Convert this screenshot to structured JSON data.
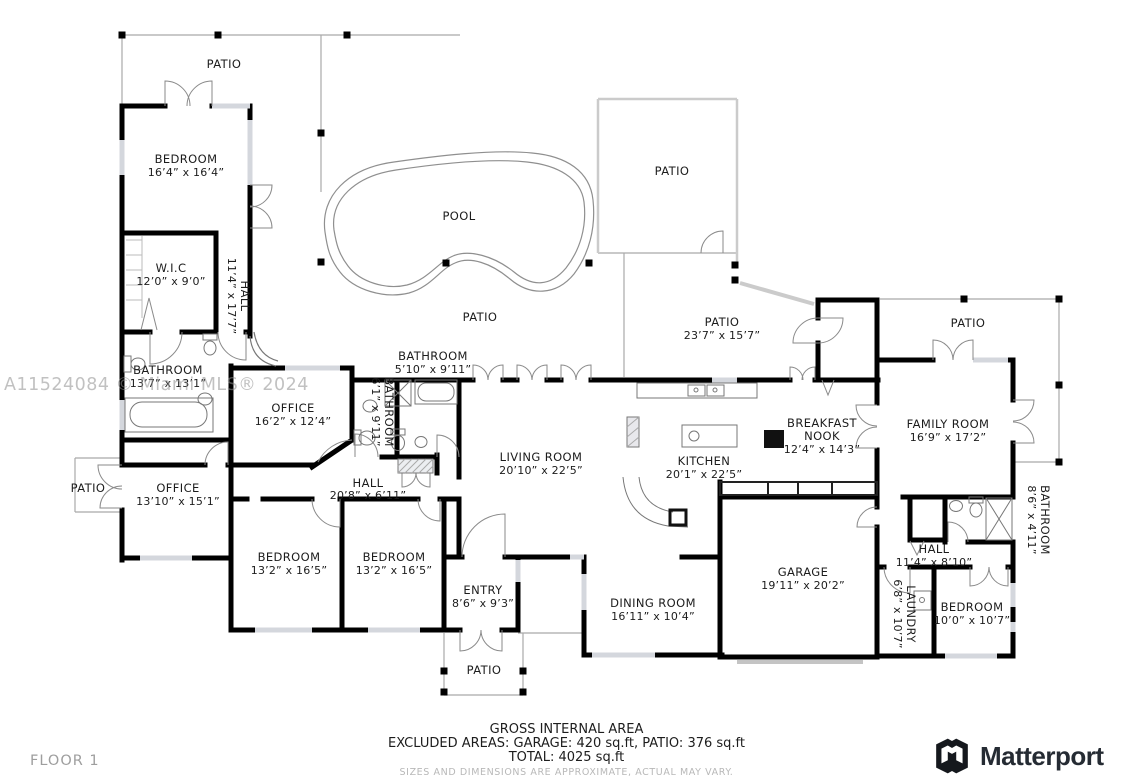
{
  "watermark": "A11524084 © Miami MLS® 2024",
  "floor_label": "FLOOR 1",
  "brand": {
    "name": "Matterport"
  },
  "footer": {
    "line1": "GROSS INTERNAL AREA",
    "line2": "EXCLUDED AREAS: GARAGE: 420 sq.ft, PATIO: 376 sq.ft",
    "line3": "TOTAL: 4025 sq.ft",
    "disclaimer": "SIZES AND DIMENSIONS ARE APPROXIMATE, ACTUAL MAY VARY."
  },
  "rooms": {
    "patio_top_left": {
      "name": "PATIO"
    },
    "bedroom1": {
      "name": "BEDROOM",
      "dims": "16’4” x 16’4”"
    },
    "wic": {
      "name": "W.I.C",
      "dims": "12’0” x 9’0”"
    },
    "hall1": {
      "name": "HALL",
      "dims": "11’4” x 17’7”"
    },
    "bathroom1": {
      "name": "BATHROOM",
      "dims": "13’7” x 13’1”"
    },
    "office1": {
      "name": "OFFICE",
      "dims": "16’2” x 12’4”"
    },
    "bathroom2": {
      "name": "BATHROOM",
      "dims": "6’1” x 9’11”"
    },
    "bathroom3": {
      "name": "BATHROOM",
      "dims": "5’10” x 9’11”"
    },
    "pool": {
      "name": "POOL"
    },
    "patio_pool": {
      "name": "PATIO"
    },
    "patio_upper_right": {
      "name": "PATIO"
    },
    "patio_right": {
      "name": "PATIO",
      "dims": "23’7” x 15’7”"
    },
    "living": {
      "name": "LIVING ROOM",
      "dims": "20’10” x 22’5”"
    },
    "kitchen": {
      "name": "KITCHEN",
      "dims": "20’1” x 22’5”"
    },
    "nook": {
      "name1": "BREAKFAST",
      "name2": "NOOK",
      "dims": "12’4” x 14’3”"
    },
    "family": {
      "name": "FAMILY ROOM",
      "dims": "16’9” x 17’2”"
    },
    "patio_top_right": {
      "name": "PATIO"
    },
    "bathroom4": {
      "name": "BATHROOM",
      "dims": "8’6” x 4’11”"
    },
    "office2": {
      "name": "OFFICE",
      "dims": "13’10” x 15’1”"
    },
    "patio_left": {
      "name": "PATIO"
    },
    "hall_main": {
      "name": "HALL",
      "dims": "20’8” x 6’11”"
    },
    "bedroom2": {
      "name": "BEDROOM",
      "dims": "13’2” x 16’5”"
    },
    "bedroom3": {
      "name": "BEDROOM",
      "dims": "13’2” x 16’5”"
    },
    "entry": {
      "name": "ENTRY",
      "dims": "8’6” x 9’3”"
    },
    "patio_bottom": {
      "name": "PATIO"
    },
    "dining": {
      "name": "DINING ROOM",
      "dims": "16’11” x 10’4”"
    },
    "garage": {
      "name": "GARAGE",
      "dims": "19’11” x 20’2”"
    },
    "hall2": {
      "name": "HALL",
      "dims": "11’4” x 8’10”"
    },
    "laundry": {
      "name": "LAUNDRY",
      "dims": "6’8” x 10’7”"
    },
    "bedroom4": {
      "name": "BEDROOM",
      "dims": "10’0” x 10’7”"
    }
  }
}
